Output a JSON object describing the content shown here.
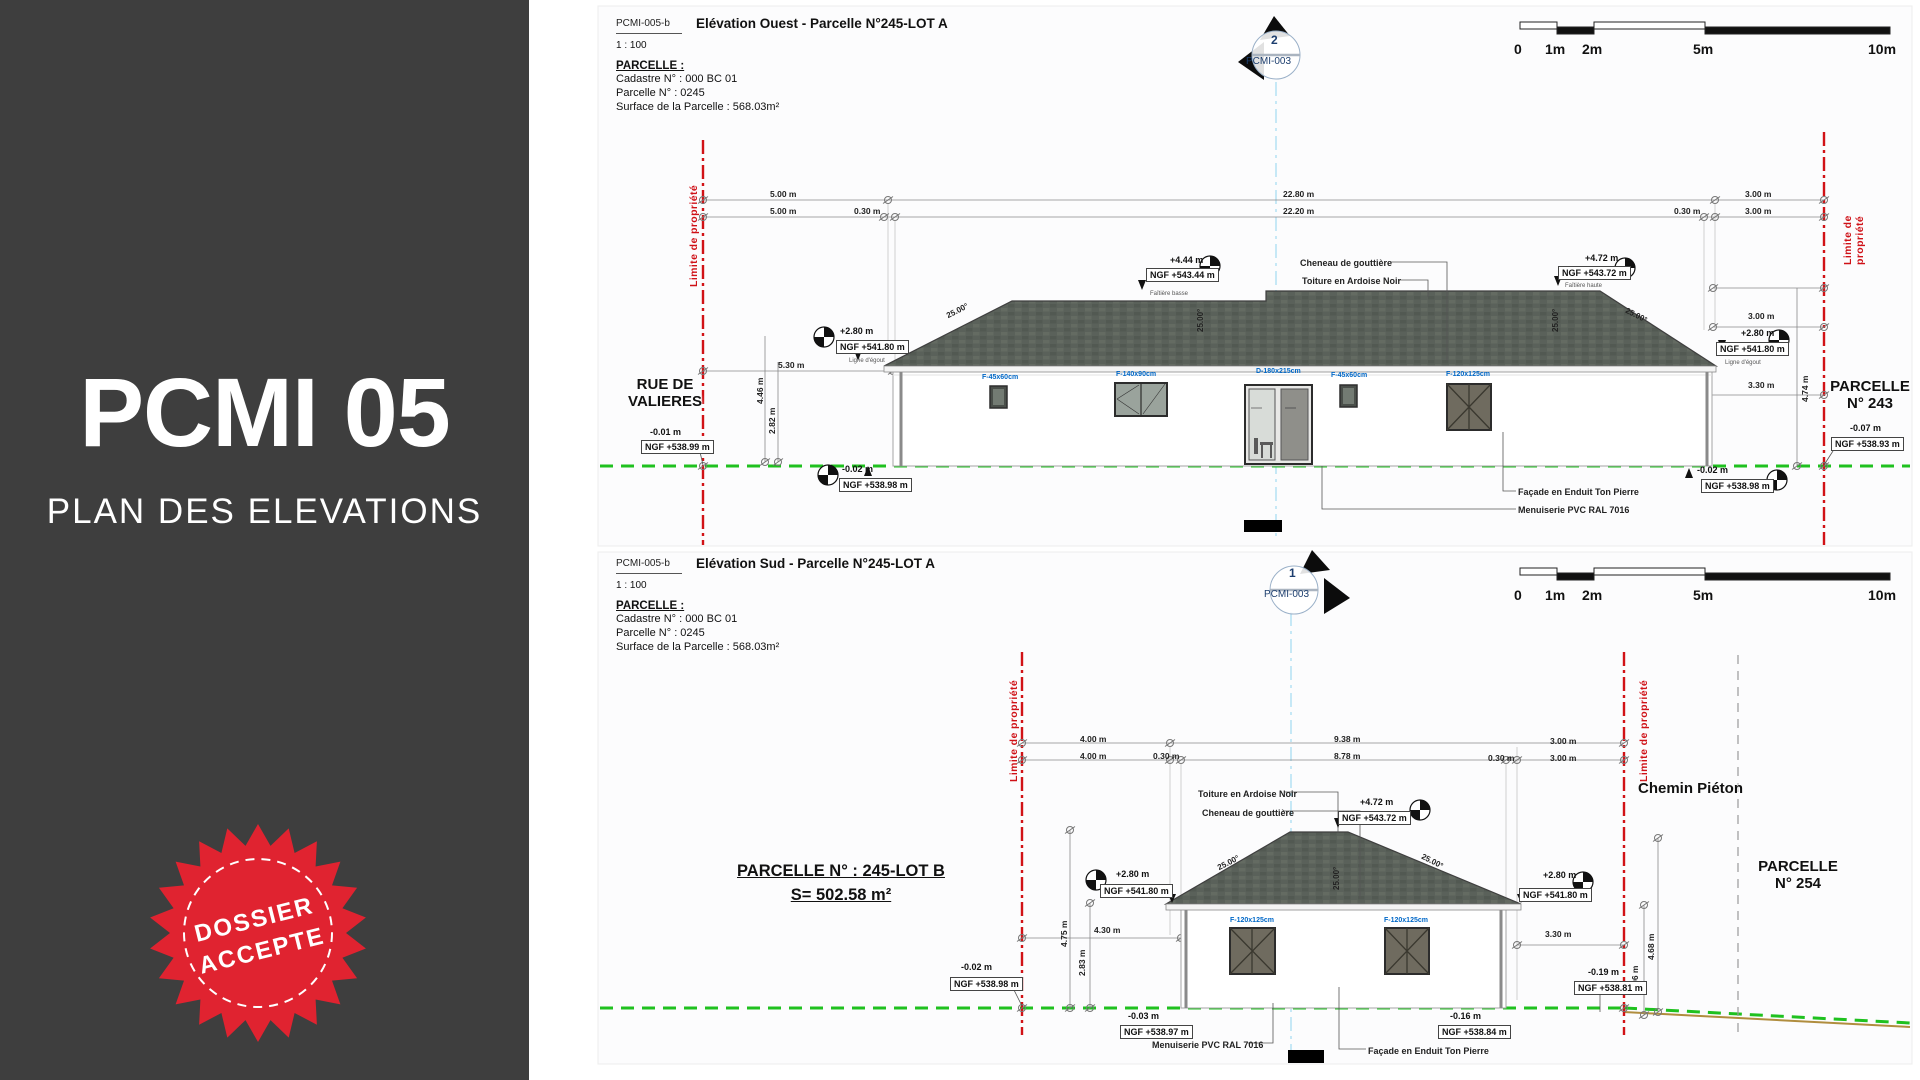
{
  "sidebar": {
    "title": "PCMI 05",
    "subtitle": "PLAN DES ELEVATIONS",
    "stamp_line1": "DOSSIER",
    "stamp_line2": "ACCEPTE"
  },
  "colors": {
    "sidebar_bg": "#3e3e3e",
    "stamp_red": "#e02330",
    "limit_red": "#d11216",
    "ground_green": "#1fc11f",
    "opening_tag_blue": "#0068c8",
    "marker_navy": "#1c3e6e",
    "roof_slate": "#5a615a"
  },
  "panels": [
    {
      "doc_ref": "PCMI-005-b",
      "title": "Elévation Ouest - Parcelle N°245-LOT A",
      "scale_label": "1 : 100",
      "parcel": {
        "heading": "PARCELLE :",
        "lines": [
          "Cadastre N° : 000 BC 01",
          "Parcelle N°  : 0245",
          "Surface de la Parcelle : 568.03m²"
        ]
      },
      "marker": {
        "num": "2",
        "ref": "PCMI-003"
      },
      "scalebar_labels": [
        "0",
        "1m",
        "2m",
        "5m",
        "10m"
      ],
      "annotations": [
        {
          "x": 770,
          "y": 190,
          "t": "5.00 m",
          "c": "dim"
        },
        {
          "x": 1283,
          "y": 190,
          "t": "22.80 m",
          "c": "dim"
        },
        {
          "x": 1745,
          "y": 190,
          "t": "3.00 m",
          "c": "dim"
        },
        {
          "x": 770,
          "y": 207,
          "t": "5.00 m",
          "c": "dim"
        },
        {
          "x": 854,
          "y": 207,
          "t": "0.30 m",
          "c": "dim"
        },
        {
          "x": 1283,
          "y": 207,
          "t": "22.20 m",
          "c": "dim"
        },
        {
          "x": 1674,
          "y": 207,
          "t": "0.30 m",
          "c": "dim"
        },
        {
          "x": 1745,
          "y": 207,
          "t": "3.00 m",
          "c": "dim"
        },
        {
          "x": 778,
          "y": 361,
          "t": "5.30 m",
          "c": "dim"
        },
        {
          "x": 1748,
          "y": 312,
          "t": "3.00 m",
          "c": "dim"
        },
        {
          "x": 1748,
          "y": 381,
          "t": "3.30 m",
          "c": "dim"
        },
        {
          "x": 756,
          "y": 404,
          "t": "4.46 m",
          "c": "dim",
          "r": -90
        },
        {
          "x": 768,
          "y": 434,
          "t": "2.82 m",
          "c": "dim",
          "r": -90
        },
        {
          "x": 1801,
          "y": 402,
          "t": "4.74 m",
          "c": "dim",
          "r": -90
        },
        {
          "x": 945,
          "y": 312,
          "t": "25.00°",
          "c": "slope",
          "r": -27
        },
        {
          "x": 1628,
          "y": 306,
          "t": "25.00°",
          "c": "slope",
          "r": 27
        },
        {
          "x": 1196,
          "y": 332,
          "t": "25.00°",
          "c": "slope",
          "r": -90
        },
        {
          "x": 1551,
          "y": 332,
          "t": "25.00°",
          "c": "slope",
          "r": -90
        },
        {
          "x": 1170,
          "y": 255,
          "t": "+4.44 m",
          "c": "lvl"
        },
        {
          "x": 1146,
          "y": 268,
          "t": "NGF +543.44 m",
          "c": "ngf"
        },
        {
          "x": 1150,
          "y": 291,
          "t": "Faîtière basse",
          "c": "tiny"
        },
        {
          "x": 1585,
          "y": 253,
          "t": "+4.72 m",
          "c": "lvl"
        },
        {
          "x": 1558,
          "y": 266,
          "t": "NGF +543.72 m",
          "c": "ngf"
        },
        {
          "x": 1565,
          "y": 283,
          "t": "Faîtière haute",
          "c": "tiny"
        },
        {
          "x": 840,
          "y": 326,
          "t": "+2.80 m",
          "c": "lvl"
        },
        {
          "x": 836,
          "y": 340,
          "t": "NGF +541.80 m",
          "c": "ngf"
        },
        {
          "x": 849,
          "y": 358,
          "t": "Ligne d'égout",
          "c": "tiny"
        },
        {
          "x": 1741,
          "y": 328,
          "t": "+2.80 m",
          "c": "lvl"
        },
        {
          "x": 1716,
          "y": 342,
          "t": "NGF +541.80 m",
          "c": "ngf"
        },
        {
          "x": 1725,
          "y": 360,
          "t": "Ligne d'égout",
          "c": "tiny"
        },
        {
          "x": 650,
          "y": 427,
          "t": "-0.01 m",
          "c": "lvl"
        },
        {
          "x": 641,
          "y": 440,
          "t": "NGF +538.99 m",
          "c": "ngf"
        },
        {
          "x": 842,
          "y": 464,
          "t": "-0.02 m",
          "c": "lvl"
        },
        {
          "x": 839,
          "y": 478,
          "t": "NGF +538.98 m",
          "c": "ngf"
        },
        {
          "x": 1697,
          "y": 465,
          "t": "-0.02 m",
          "c": "lvl"
        },
        {
          "x": 1701,
          "y": 479,
          "t": "NGF +538.98 m",
          "c": "ngf"
        },
        {
          "x": 1850,
          "y": 423,
          "t": "-0.07 m",
          "c": "lvl"
        },
        {
          "x": 1831,
          "y": 437,
          "t": "NGF +538.93 m",
          "c": "ngf"
        },
        {
          "x": 1300,
          "y": 258,
          "t": "Cheneau de gouttière",
          "c": "note"
        },
        {
          "x": 1302,
          "y": 276,
          "t": "Toiture en Ardoise Noir",
          "c": "note"
        },
        {
          "x": 1518,
          "y": 487,
          "t": "Façade en Enduit Ton Pierre",
          "c": "note"
        },
        {
          "x": 1518,
          "y": 505,
          "t": "Menuiserie PVC RAL 7016",
          "c": "note"
        },
        {
          "x": 982,
          "y": 374,
          "t": "F-45x60cm",
          "c": "blue"
        },
        {
          "x": 1116,
          "y": 371,
          "t": "F-140x90cm",
          "c": "blue"
        },
        {
          "x": 1256,
          "y": 368,
          "t": "D-180x215cm",
          "c": "blue"
        },
        {
          "x": 1331,
          "y": 372,
          "t": "F-45x60cm",
          "c": "blue"
        },
        {
          "x": 1446,
          "y": 371,
          "t": "F-120x125cm",
          "c": "blue"
        },
        {
          "x": 688,
          "y": 287,
          "t": "Limite de propriété",
          "c": "redv",
          "r": -90
        },
        {
          "x": 1842,
          "y": 265,
          "t": "Limite de propriété",
          "c": "redv",
          "r": -90
        },
        {
          "x": 610,
          "y": 376,
          "t": "RUE DE\nVALIERES",
          "c": "big",
          "w": 110
        },
        {
          "x": 1822,
          "y": 378,
          "t": "PARCELLE\nN° 243",
          "c": "big",
          "w": 96
        }
      ]
    },
    {
      "doc_ref": "PCMI-005-b",
      "title": "Elévation Sud - Parcelle N°245-LOT A",
      "scale_label": "1 : 100",
      "parcel": {
        "heading": "PARCELLE :",
        "lines": [
          "Cadastre N° : 000 BC 01",
          "Parcelle N°  : 0245",
          "Surface de la Parcelle : 568.03m²"
        ]
      },
      "marker": {
        "num": "1",
        "ref": "PCMI-003"
      },
      "scalebar_labels": [
        "0",
        "1m",
        "2m",
        "5m",
        "10m"
      ],
      "annotations": [
        {
          "x": 1080,
          "y": 735,
          "t": "4.00 m",
          "c": "dim"
        },
        {
          "x": 1334,
          "y": 735,
          "t": "9.38 m",
          "c": "dim"
        },
        {
          "x": 1550,
          "y": 737,
          "t": "3.00 m",
          "c": "dim"
        },
        {
          "x": 1080,
          "y": 752,
          "t": "4.00 m",
          "c": "dim"
        },
        {
          "x": 1153,
          "y": 752,
          "t": "0.30 m",
          "c": "dim"
        },
        {
          "x": 1334,
          "y": 752,
          "t": "8.78 m",
          "c": "dim"
        },
        {
          "x": 1488,
          "y": 754,
          "t": "0.30 m",
          "c": "dim"
        },
        {
          "x": 1550,
          "y": 754,
          "t": "3.00 m",
          "c": "dim"
        },
        {
          "x": 1094,
          "y": 926,
          "t": "4.30 m",
          "c": "dim"
        },
        {
          "x": 1545,
          "y": 930,
          "t": "3.30 m",
          "c": "dim"
        },
        {
          "x": 1060,
          "y": 947,
          "t": "4.75 m",
          "c": "dim",
          "r": -90
        },
        {
          "x": 1078,
          "y": 976,
          "t": "2.83 m",
          "c": "dim",
          "r": -90
        },
        {
          "x": 1647,
          "y": 960,
          "t": "4.68 m",
          "c": "dim",
          "r": -90
        },
        {
          "x": 1631,
          "y": 992,
          "t": "2.96 m",
          "c": "dim",
          "r": -90
        },
        {
          "x": 1216,
          "y": 864,
          "t": "25.00°",
          "c": "slope",
          "r": -27
        },
        {
          "x": 1424,
          "y": 852,
          "t": "25.00°",
          "c": "slope",
          "r": 27
        },
        {
          "x": 1332,
          "y": 890,
          "t": "25.00°",
          "c": "slope",
          "r": -90
        },
        {
          "x": 1360,
          "y": 797,
          "t": "+4.72 m",
          "c": "lvl"
        },
        {
          "x": 1338,
          "y": 811,
          "t": "NGF +543.72 m",
          "c": "ngf"
        },
        {
          "x": 1116,
          "y": 869,
          "t": "+2.80 m",
          "c": "lvl"
        },
        {
          "x": 1100,
          "y": 884,
          "t": "NGF +541.80 m",
          "c": "ngf"
        },
        {
          "x": 1543,
          "y": 870,
          "t": "+2.80 m",
          "c": "lvl"
        },
        {
          "x": 1519,
          "y": 888,
          "t": "NGF +541.80 m",
          "c": "ngf"
        },
        {
          "x": 961,
          "y": 962,
          "t": "-0.02 m",
          "c": "lvl"
        },
        {
          "x": 950,
          "y": 977,
          "t": "NGF +538.98 m",
          "c": "ngf"
        },
        {
          "x": 1128,
          "y": 1011,
          "t": "-0.03 m",
          "c": "lvl"
        },
        {
          "x": 1120,
          "y": 1025,
          "t": "NGF +538.97 m",
          "c": "ngf"
        },
        {
          "x": 1450,
          "y": 1011,
          "t": "-0.16 m",
          "c": "lvl"
        },
        {
          "x": 1438,
          "y": 1025,
          "t": "NGF +538.84 m",
          "c": "ngf"
        },
        {
          "x": 1588,
          "y": 967,
          "t": "-0.19 m",
          "c": "lvl"
        },
        {
          "x": 1574,
          "y": 981,
          "t": "NGF +538.81 m",
          "c": "ngf"
        },
        {
          "x": 1198,
          "y": 789,
          "t": "Toiture en Ardoise Noir",
          "c": "note"
        },
        {
          "x": 1202,
          "y": 808,
          "t": "Cheneau de gouttière",
          "c": "note"
        },
        {
          "x": 1152,
          "y": 1040,
          "t": "Menuiserie PVC RAL 7016",
          "c": "note"
        },
        {
          "x": 1368,
          "y": 1046,
          "t": "Façade en Enduit Ton Pierre",
          "c": "note"
        },
        {
          "x": 1230,
          "y": 917,
          "t": "F-120x125cm",
          "c": "blue"
        },
        {
          "x": 1384,
          "y": 917,
          "t": "F-120x125cm",
          "c": "blue"
        },
        {
          "x": 1008,
          "y": 782,
          "t": "Limite de propriété",
          "c": "redv",
          "r": -90
        },
        {
          "x": 1638,
          "y": 782,
          "t": "Limite de propriété",
          "c": "redv",
          "r": -90
        },
        {
          "x": 1638,
          "y": 780,
          "t": "Chemin Piéton",
          "c": "big"
        },
        {
          "x": 1748,
          "y": 858,
          "t": "PARCELLE\nN° 254",
          "c": "big",
          "w": 100
        },
        {
          "x": 735,
          "y": 862,
          "t": "PARCELLE N° : 245-LOT B",
          "c": "head",
          "w": 212
        },
        {
          "x": 735,
          "y": 886,
          "t": "S= 502.58 m²",
          "c": "head",
          "w": 212
        }
      ]
    }
  ]
}
